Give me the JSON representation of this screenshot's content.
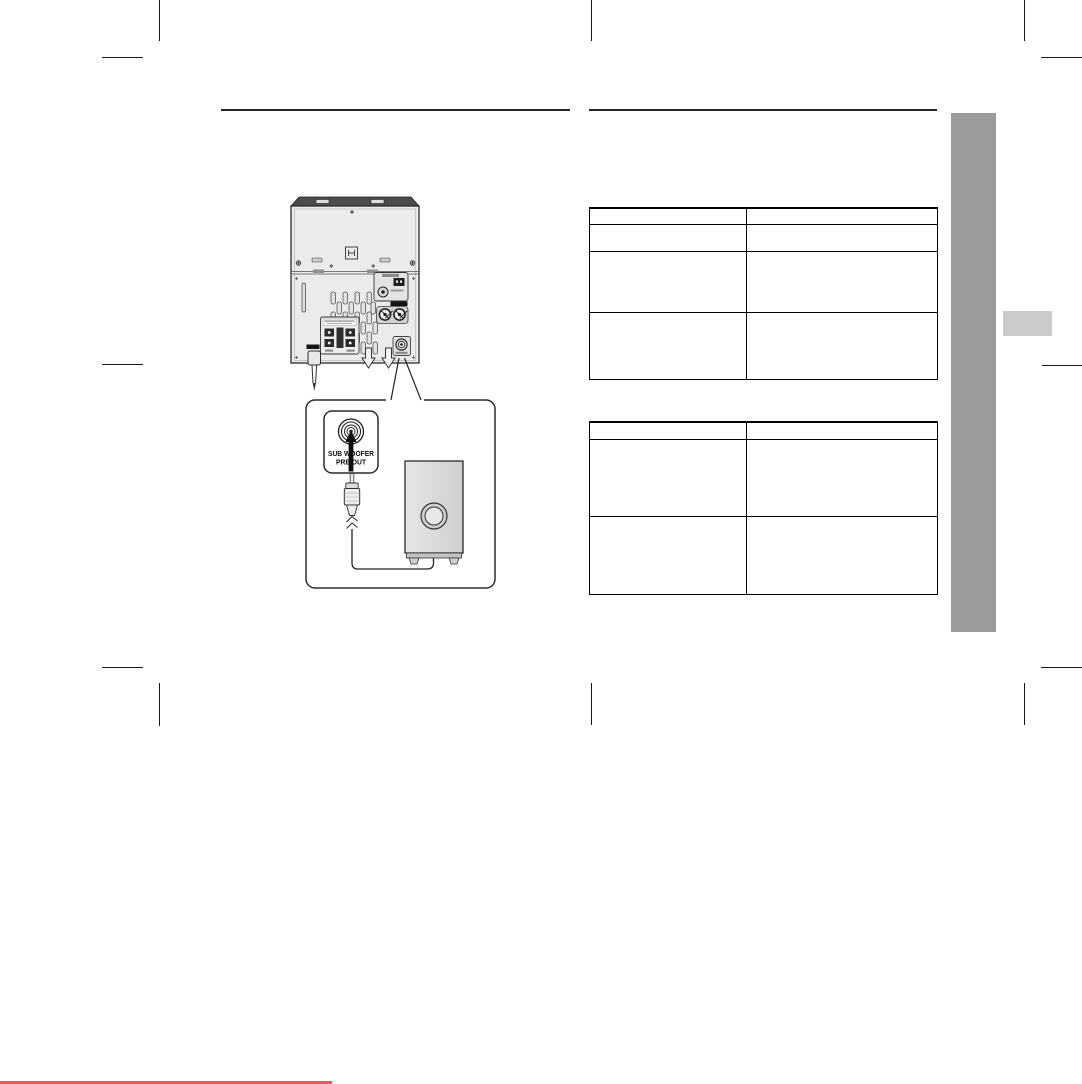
{
  "diagram": {
    "jack_label": {
      "line1": "SUB WOOFER",
      "line2": "PRE OUT"
    }
  },
  "tables": {
    "table_top": {
      "header": [
        "",
        ""
      ],
      "rows": [
        [
          "",
          ""
        ],
        [
          "",
          ""
        ],
        [
          "",
          ""
        ]
      ]
    },
    "table_bottom": {
      "header": [
        "",
        ""
      ],
      "rows": [
        [
          "",
          ""
        ],
        [
          "",
          ""
        ]
      ]
    }
  },
  "colors": {
    "side_bar": "#9b9b9b",
    "side_tab": "#cbcbcb",
    "footer_accent_line": "#e35f5c",
    "header_rule": "#262626",
    "table_border": "#000000",
    "crop_mark": "#1a1a1a"
  },
  "icons": {
    "rca_jack": "concentric circles",
    "up_arrow": "solid black arrow pointing up into jack",
    "down_arrow_vent": "hollow outline arrow pointing down",
    "fm_coax_jack": "circle with center pin",
    "aux_rca_jack": "circle with X",
    "screw": "circle with cross",
    "rca_plug": "cylindrical plug with pin",
    "cable_break": "zigzag cable break"
  }
}
